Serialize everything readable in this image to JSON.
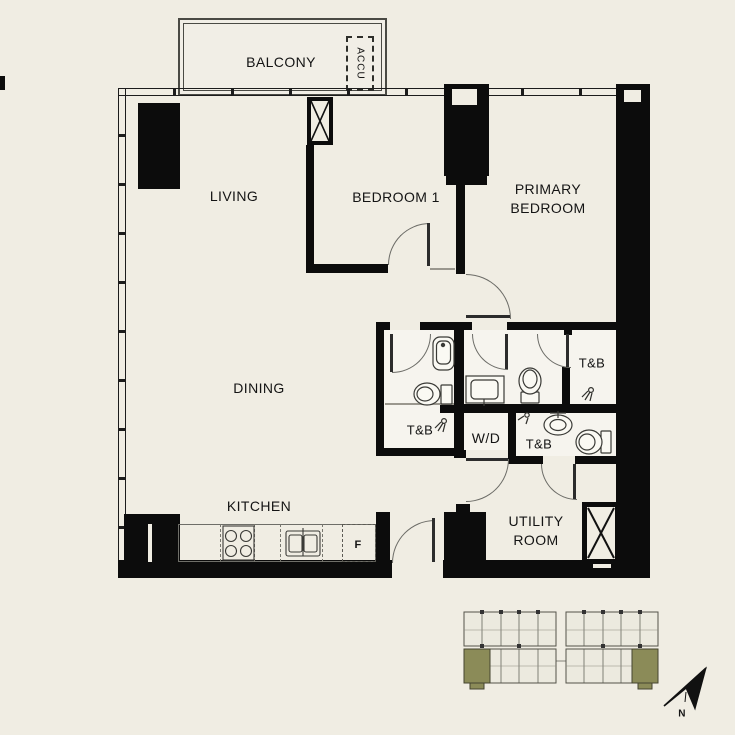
{
  "rooms": {
    "balcony": "BALCONY",
    "accu": "ACCU",
    "living": "LIVING",
    "bedroom1": "BEDROOM 1",
    "primary_bedroom": {
      "line1": "PRIMARY",
      "line2": "BEDROOM"
    },
    "dining": "DINING",
    "kitchen": "KITCHEN",
    "utility": {
      "line1": "UTILITY",
      "line2": "ROOM"
    },
    "tb_left": "T&B",
    "tb_right": "T&B",
    "tb_lower": "T&B",
    "wd": "W/D",
    "fridge": "F"
  },
  "compass": {
    "north": "N"
  },
  "colors": {
    "background": "#f0ede3",
    "wall": "#0c0c0c",
    "keyplan_highlight": "#8b8b58"
  }
}
